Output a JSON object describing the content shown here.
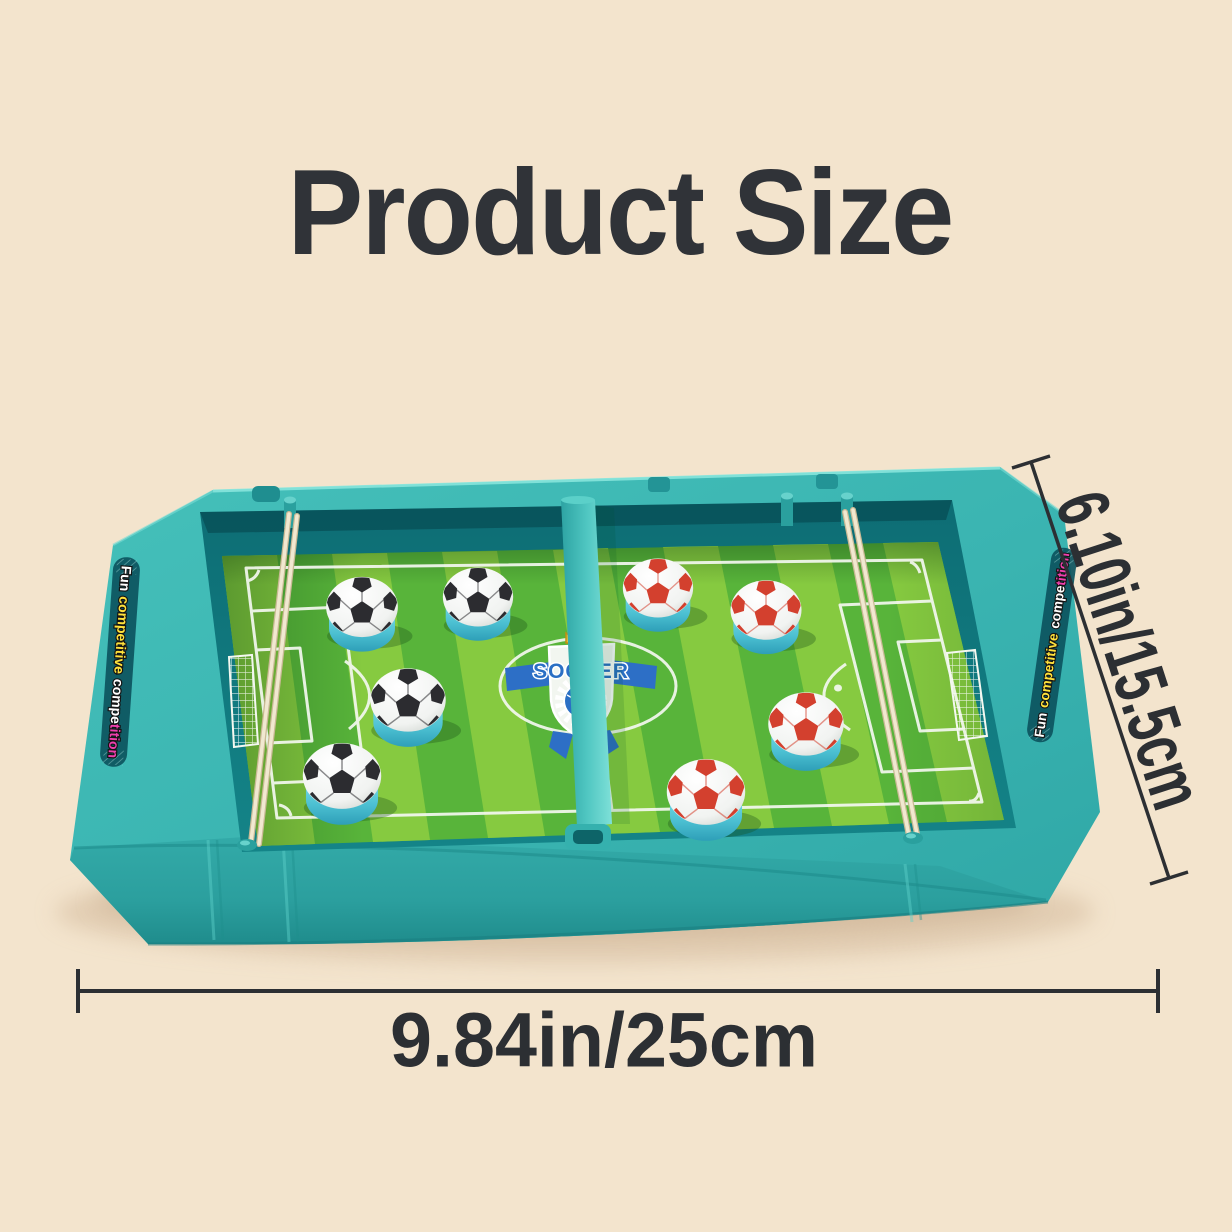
{
  "title": "Product Size",
  "dimensions": {
    "width": "9.84in/25cm",
    "height": "6.10in/15.5cm"
  },
  "board": {
    "logo_text": "SOCCER",
    "side_label": {
      "word1": "Fun",
      "word2": "competitive",
      "word3a": "compe",
      "word3b": "tition"
    },
    "pucks": {
      "left": {
        "count": 4,
        "style": "black-white soccer puck"
      },
      "right": {
        "count": 4,
        "style": "red-white soccer puck"
      }
    },
    "colors": {
      "tray_teal": "#3cb8b4",
      "field_light_green": "#86ca40",
      "field_dark_green": "#58b43a",
      "label_yellow": "#ffe23c",
      "label_magenta": "#ef3fae",
      "puck_black": "#2c2c30",
      "puck_red": "#d3402e",
      "logo_blue": "#2a6fc4",
      "elastic_cream": "#f1e8d0"
    }
  },
  "canvas": {
    "background": "#f3e4cd",
    "annotation_color": "#2c2f33"
  }
}
